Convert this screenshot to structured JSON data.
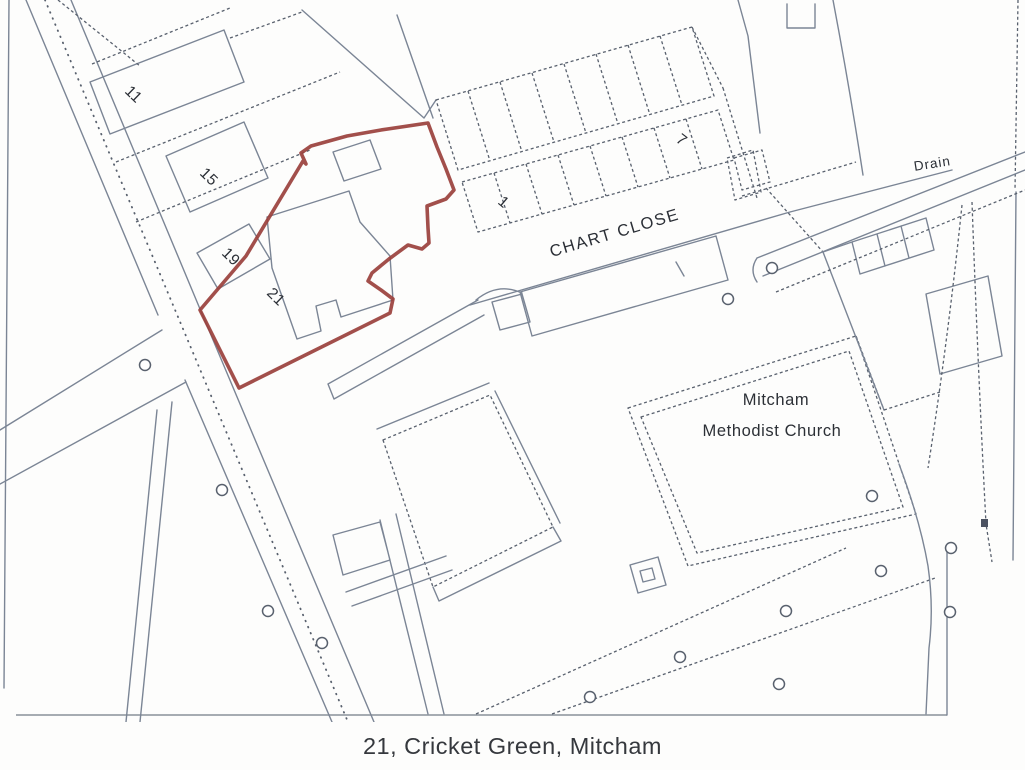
{
  "caption": {
    "text": "21, Cricket Green, Mitcham"
  },
  "map": {
    "street_label": "CHART CLOSE",
    "drain_label": "Drain",
    "church_label": {
      "line1": "Mitcham",
      "line2": "Methodist Church"
    },
    "house_numbers": [
      {
        "text": "11"
      },
      {
        "text": "15"
      },
      {
        "text": "19"
      },
      {
        "text": "21"
      },
      {
        "text": "1"
      },
      {
        "text": "7"
      }
    ]
  },
  "colors": {
    "boundary-red": "#9a403c",
    "line-solid": "#7b8595",
    "line-dash": "#59616e",
    "ink": "#2b2f36",
    "paper": "#fdfdfc",
    "border-gray": "#9aa0a8"
  }
}
